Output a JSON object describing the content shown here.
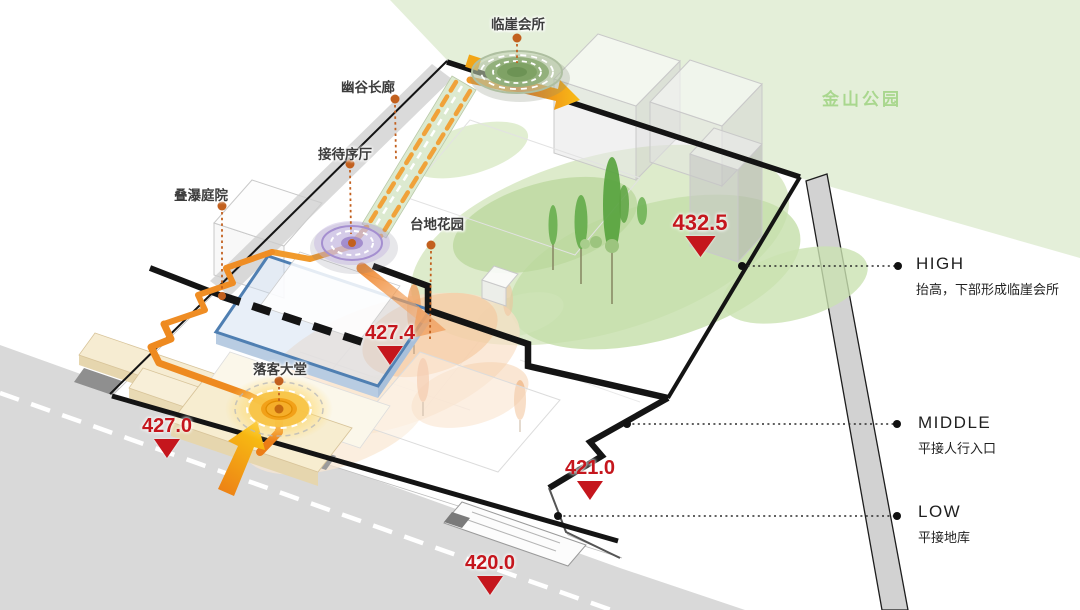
{
  "scene": {
    "park": {
      "label": "金山公园"
    },
    "site_labels": {
      "cliff_club": "临崖会所",
      "valley_corridor": "幽谷长廊",
      "reception_hall": "接待序厅",
      "cascade_courtyard": "叠瀑庭院",
      "terrace_garden": "台地花园",
      "dropoff_hall": "落客大堂"
    },
    "elevation_markers": {
      "e432_5": "432.5",
      "e427_4": "427.4",
      "e427_0": "427.0",
      "e421_0": "421.0",
      "e420_0": "420.0"
    },
    "level_annotations": {
      "high": {
        "title": "HIGH",
        "desc": "抬高，下部形成临崖会所"
      },
      "middle": {
        "title": "MIDDLE",
        "desc": "平接人行入口"
      },
      "low": {
        "title": "LOW",
        "desc": "平接地库"
      }
    },
    "colors": {
      "park_green": "#e4efd9",
      "park_label_green": "#a9d78e",
      "marker_red": "#c5161d",
      "flow_orange": "#f19a2c",
      "deep_orange": "#e2671d",
      "leader_orange": "#c2601e",
      "outline_black": "#141414",
      "building_blue": "#4f7fb2",
      "spiral_purple": "#9b84c9",
      "road_gray": "#d9d9d9"
    }
  }
}
